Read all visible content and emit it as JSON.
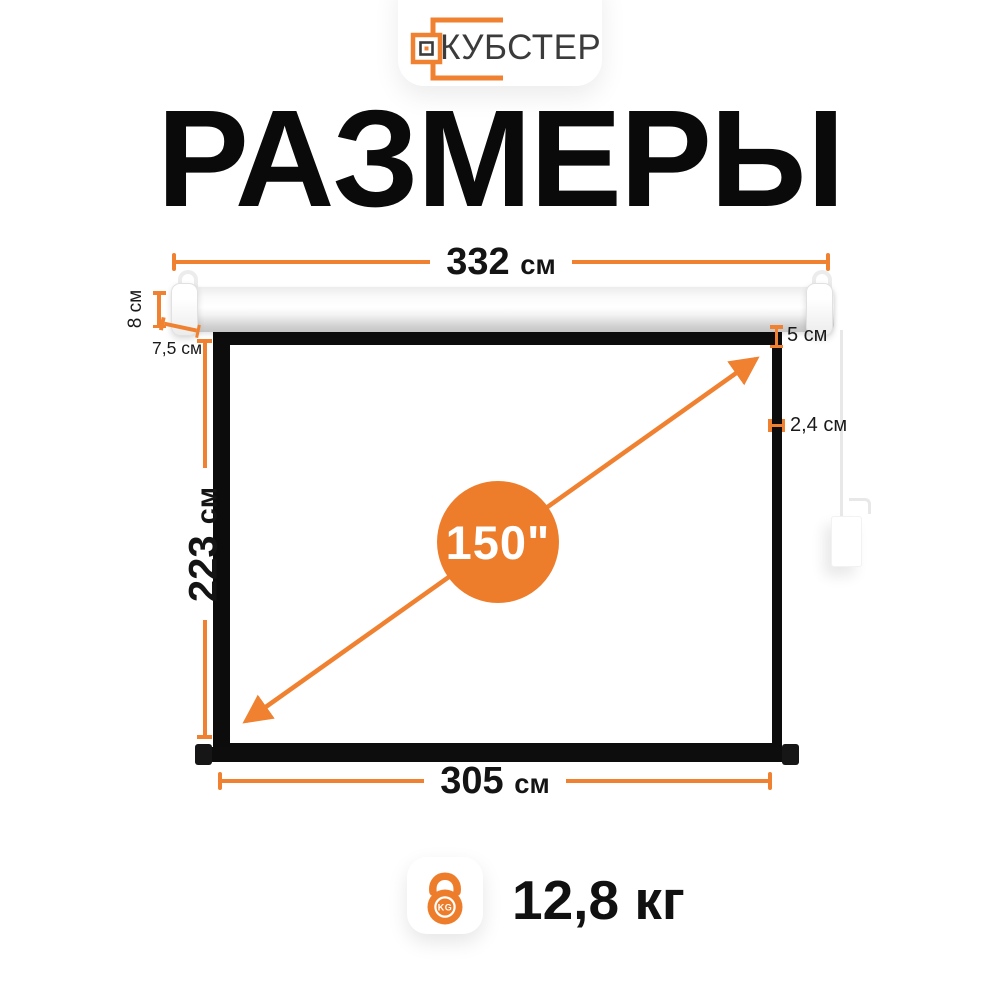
{
  "colors": {
    "accent": "#EF8130",
    "accent_solid": "#EE7D2B",
    "frame_black": "#0c0c0c"
  },
  "logo": {
    "brand": "КУБСТЕР",
    "icon": "cubster-logo-icon"
  },
  "title": "РАЗМЕРЫ",
  "dimensions": {
    "total_width": {
      "value": "332",
      "unit": "см"
    },
    "case_height": {
      "value": "8",
      "unit": "см",
      "label": "8 см"
    },
    "left_offset": {
      "value": "7,5",
      "unit": "см",
      "label": "7,5 см"
    },
    "screen_height": {
      "value": "223",
      "unit": "см"
    },
    "top_border": {
      "value": "5",
      "unit": "см",
      "label": "5 см"
    },
    "side_border": {
      "value": "2,4",
      "unit": "см",
      "label": "2,4 см"
    },
    "screen_width": {
      "value": "305",
      "unit": "см"
    },
    "diagonal": {
      "label": "150\""
    }
  },
  "weight": {
    "value": "12,8 кг",
    "icon": "kettlebell-icon",
    "badge": "KG"
  }
}
